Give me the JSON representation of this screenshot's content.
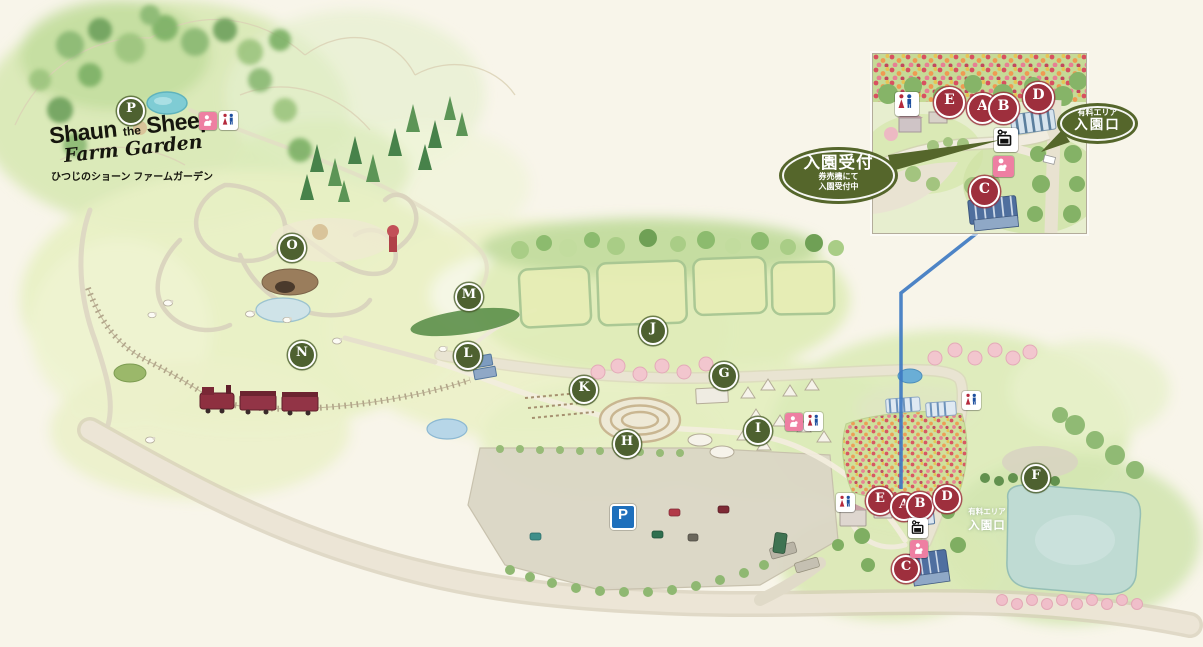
{
  "logo": {
    "word1": "Shaun",
    "word2": "the",
    "word3": "Sheep",
    "script_line": "Farm Garden",
    "subtitle": "ひつじのショーン ファームガーデン"
  },
  "markers": {
    "main": [
      {
        "letter": "P",
        "x": 129,
        "y": 109,
        "color": "green"
      },
      {
        "letter": "O",
        "x": 290,
        "y": 246,
        "color": "green"
      },
      {
        "letter": "M",
        "x": 467,
        "y": 295,
        "color": "green"
      },
      {
        "letter": "N",
        "x": 300,
        "y": 353,
        "color": "green"
      },
      {
        "letter": "L",
        "x": 466,
        "y": 354,
        "color": "green"
      },
      {
        "letter": "K",
        "x": 582,
        "y": 388,
        "color": "green"
      },
      {
        "letter": "J",
        "x": 651,
        "y": 329,
        "color": "green"
      },
      {
        "letter": "H",
        "x": 625,
        "y": 442,
        "color": "green"
      },
      {
        "letter": "I",
        "x": 756,
        "y": 429,
        "color": "green"
      },
      {
        "letter": "G",
        "x": 722,
        "y": 374,
        "color": "green"
      },
      {
        "letter": "F",
        "x": 1034,
        "y": 476,
        "color": "green"
      },
      {
        "letter": "E",
        "x": 878,
        "y": 499,
        "color": "red"
      },
      {
        "letter": "A",
        "x": 902,
        "y": 505,
        "color": "red"
      },
      {
        "letter": "B",
        "x": 918,
        "y": 504,
        "color": "red"
      },
      {
        "letter": "D",
        "x": 945,
        "y": 497,
        "color": "red"
      },
      {
        "letter": "C",
        "x": 904,
        "y": 567,
        "color": "red"
      }
    ],
    "inset": [
      {
        "letter": "E",
        "x": 75,
        "y": 47
      },
      {
        "letter": "A",
        "x": 108,
        "y": 53
      },
      {
        "letter": "B",
        "x": 129,
        "y": 53
      },
      {
        "letter": "D",
        "x": 164,
        "y": 42
      },
      {
        "letter": "C",
        "x": 110,
        "y": 136
      }
    ]
  },
  "labels": {
    "reception_title": "入園受付",
    "reception_note1": "券売機にて",
    "reception_note2": "入園受付中",
    "paid_area": "有料エリア",
    "entrance_gate": "入園口",
    "parking_letter": "P"
  },
  "icons": [
    "parking-icon",
    "toilet-icon",
    "nursing-room-icon",
    "ticket-machine-icon"
  ],
  "colors": {
    "marker_green": "#4e6130",
    "marker_red": "#9e2f3d",
    "bubble_green": "#55662b",
    "parking_blue": "#1e6fbc",
    "connector_blue": "#3e7ac2",
    "background": "#f8f5ea"
  }
}
